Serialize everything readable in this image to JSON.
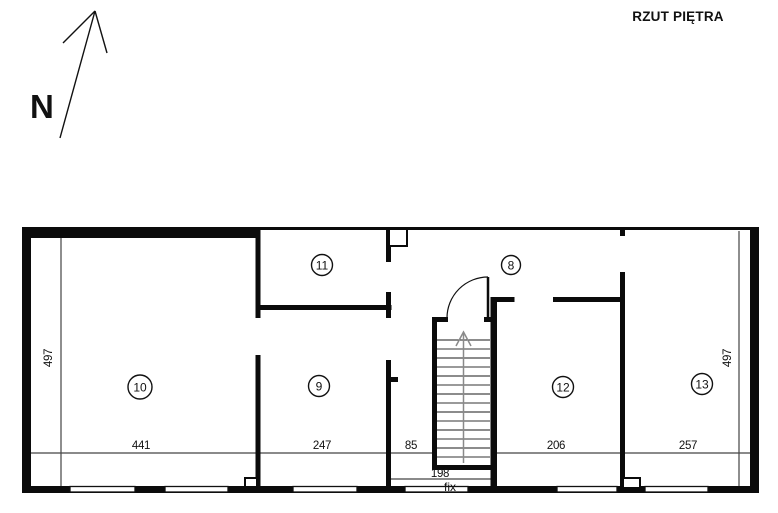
{
  "title": "RZUT PIĘTRA",
  "compass": {
    "label": "N"
  },
  "floor_plan": {
    "rooms": [
      {
        "number": "10"
      },
      {
        "number": "11"
      },
      {
        "number": "9"
      },
      {
        "number": "8"
      },
      {
        "number": "12"
      },
      {
        "number": "13"
      }
    ],
    "dimensions": {
      "left_height": "497",
      "right_height": "497",
      "room10_width": "441",
      "room9_width": "247",
      "corridor_width": "85",
      "room12_width": "206",
      "room13_width": "257",
      "stair_bay_width": "198",
      "window_note": "fix"
    }
  }
}
